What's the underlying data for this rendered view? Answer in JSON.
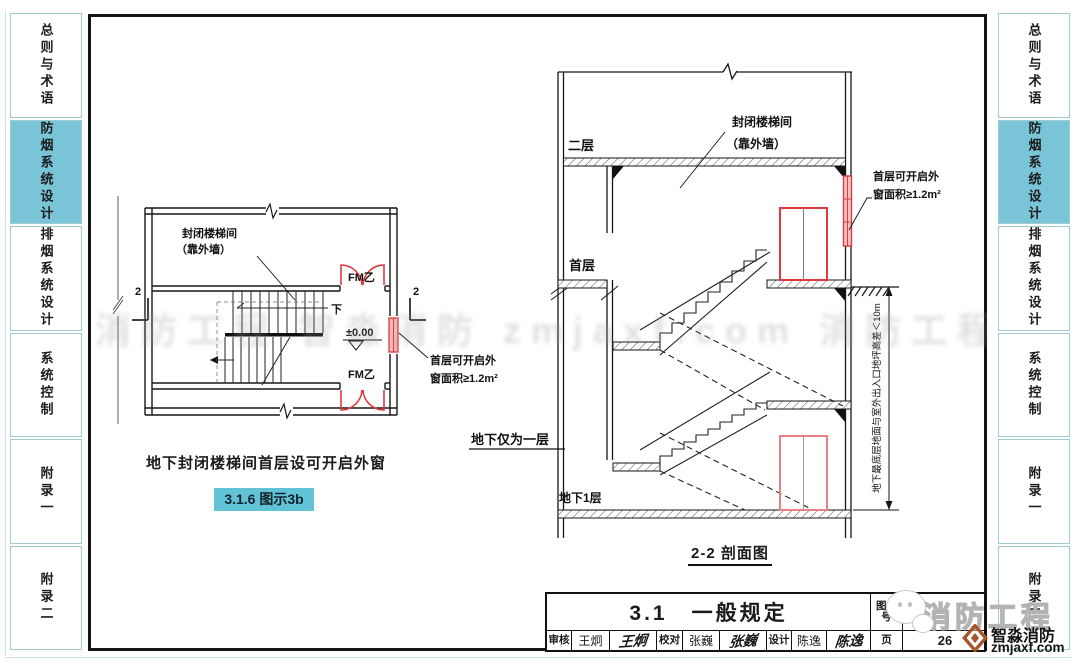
{
  "colors": {
    "accent": "#7ac4d8",
    "badge": "#62c2d6",
    "red": "#dd3a3e",
    "redlt": "#ea8084",
    "logo": "#a8552a"
  },
  "sidebar": {
    "tabs": [
      {
        "label": "总则与术语",
        "active": false
      },
      {
        "label": "防烟系统设计",
        "active": true
      },
      {
        "label": "排烟系统设计",
        "active": false
      },
      {
        "label": "系统控制",
        "active": false
      },
      {
        "label": "附录一",
        "active": false
      },
      {
        "label": "附录二",
        "active": false
      }
    ]
  },
  "plan_figure": {
    "labels": {
      "stairwell": "封闭楼梯间",
      "stairwell_sub": "（靠外墙）",
      "door1": "FM乙",
      "door2": "FM乙",
      "elevation": "±0.00",
      "down": "下",
      "section_mark": "2",
      "window_note_line1": "首层可开启外",
      "window_note_line2": "窗面积≥1.2m²"
    },
    "caption": "地下封闭楼梯间首层设可开启外窗",
    "badge": "3.1.6 图示3b"
  },
  "section_figure": {
    "labels": {
      "floor2": "二层",
      "floor1": "首层",
      "basement": "地下1层",
      "stairwell": "封闭楼梯间",
      "stairwell_sub": "（靠外墙）",
      "window_note_line1": "首层可开启外",
      "window_note_line2": "窗面积≥1.2m²",
      "basement_note": "地下仅为一层",
      "dim_note": "地下最底层地面与室外出入口地坪高差＜10m"
    },
    "caption": "2-2 剖面图"
  },
  "title_block": {
    "section_title": "3.1　一般规定",
    "atlas_label": "图集号",
    "atlas_value_fragment": "1:",
    "page_label": "页",
    "page_value": "26",
    "reviewer_label": "审核",
    "reviewer_name": "王炯",
    "reviewer_sign": "王炯",
    "checker_label": "校对",
    "checker_name": "张巍",
    "checker_sign": "张巍",
    "designer_label": "设计",
    "designer_name": "陈逸",
    "designer_sign": "陈逸"
  },
  "watermark": {
    "band_text": "消防工程 智淼消防 zmjaxf.com 消防工程 智淼消防 zmjaxf.com",
    "brand_large": "消防工程",
    "brand_name": "智淼消防",
    "brand_url": "zmjaxf.com"
  }
}
